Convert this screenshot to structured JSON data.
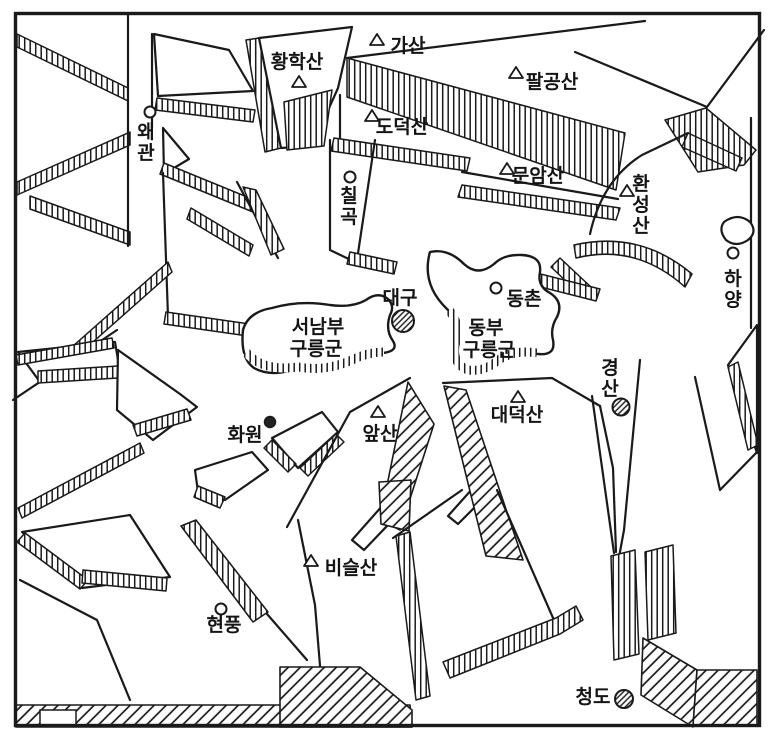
{
  "figure": {
    "kind": "hand-drawn block-diagram relief map",
    "region": "Daegu basin and surrounding fault blocks"
  },
  "colors": {
    "ink": "#1a1a1a",
    "paper": "#ffffff"
  },
  "markers": {
    "mountain": "triangle-outline-icon",
    "town": "small-circle-icon",
    "city": "hatched-circle-icon"
  },
  "labels": {
    "mountains": [
      {
        "name": "hwanghaksan",
        "text": "황학산"
      },
      {
        "name": "gasan",
        "text": "가산"
      },
      {
        "name": "palgongsan",
        "text": "팔공산"
      },
      {
        "name": "dodeoksan",
        "text": "도덕산"
      },
      {
        "name": "munamsan",
        "text": "문암산"
      },
      {
        "name": "hwanseongsan",
        "text": "환성산"
      },
      {
        "name": "daedeoksan",
        "text": "대덕산"
      },
      {
        "name": "apsan",
        "text": "앞산"
      },
      {
        "name": "biseulsan",
        "text": "비슬산"
      }
    ],
    "towns": [
      {
        "name": "waegwan",
        "text": "왜관"
      },
      {
        "name": "chilgok",
        "text": "칠곡"
      },
      {
        "name": "dongchon",
        "text": "동촌"
      },
      {
        "name": "hayang",
        "text": "하양"
      },
      {
        "name": "hwawon",
        "text": "화원"
      },
      {
        "name": "hyeonpung",
        "text": "현풍"
      }
    ],
    "cities": [
      {
        "name": "daegu",
        "text": "대구"
      },
      {
        "name": "gyeongsan",
        "text": "경산"
      },
      {
        "name": "cheongdo",
        "text": "청도"
      }
    ],
    "areas": [
      {
        "name": "seonambu-hills",
        "text": "서남부 구릉군",
        "lines": [
          "서남부",
          "구릉군"
        ]
      },
      {
        "name": "dongbu-hills",
        "text": "동부 구릉군",
        "lines": [
          "동부",
          "구릉군"
        ]
      }
    ]
  }
}
